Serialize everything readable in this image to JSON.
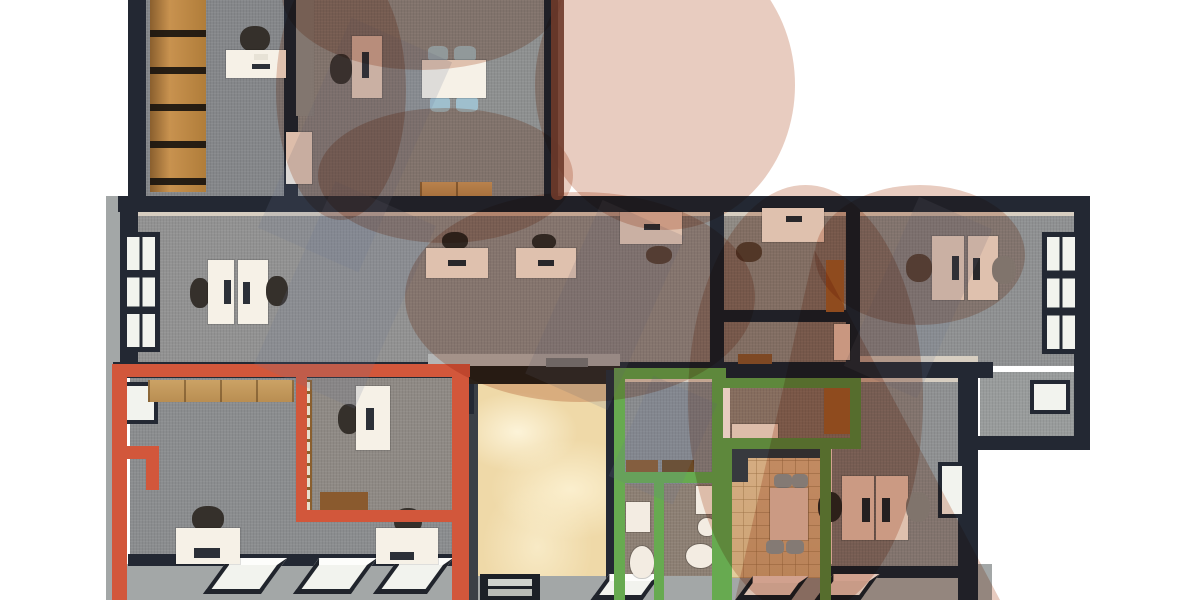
{
  "scene": {
    "kind": "3d-office-floor-plan-render",
    "visible_text": [],
    "watermark": {
      "description": "large translucent swirl logo over plan",
      "color": "#c98669",
      "dark_edge_color": "#6e3a2a"
    },
    "highlight_outlines": {
      "red_zone_color": "#d2573b",
      "green_zone_color": "#67aa50"
    }
  },
  "colors": {
    "wall": "#232833",
    "wall_inner": "#d7cec1",
    "exterior": "#a3a7a7",
    "red_zone": "#d2573b",
    "green_zone": "#67aa50",
    "marble": "#efd9a8",
    "tile": "#ead8ad",
    "wood": "#c8924f",
    "wood_light": "#cba265",
    "door_wood": "#ad7434",
    "desk": "#f6f1e7",
    "chair_dark": "#35302b",
    "chair_blue": "#9fbfcd",
    "fixture": "#f3ece2",
    "mat": "#8a5a2e",
    "glass": "#f2f3ee",
    "slate": "#3c4752",
    "watermark_rgba": "rgba(201,134,105,0.42)",
    "watermark_dark": "#6e3a2a"
  },
  "rooms": [
    {
      "id": "office-top-left",
      "floor": "#85878a",
      "contents": {
        "bookshelves": 1,
        "desks": 1,
        "chairs": 1
      }
    },
    {
      "id": "meeting-office-top-middle",
      "floor": "#8e9090",
      "contents": {
        "desks": 1,
        "tables": 1,
        "blue_chairs": 4,
        "sideboards": 1,
        "doors": 1
      }
    },
    {
      "id": "open-office",
      "floor": "#929292",
      "contents": {
        "desks": 5,
        "chairs": 5,
        "windows": 1
      }
    },
    {
      "id": "office-a-center",
      "floor": "#8f8a84",
      "contents": {
        "desks": 1,
        "chairs": 1,
        "doors": 1
      }
    },
    {
      "id": "small-room-b",
      "floor": "#8f8a84",
      "contents": {
        "mats": 1,
        "doors": 1
      }
    },
    {
      "id": "office-c-right",
      "floor": "#8f9192",
      "contents": {
        "desks": 2,
        "chairs": 2,
        "windows": 1
      }
    },
    {
      "id": "right-annex",
      "floor": "#999c9c",
      "contents": {
        "windows": 1
      }
    },
    {
      "id": "red-zone-team-room",
      "floor": "#8b8d8f",
      "contents": {
        "cabinets": 1,
        "desks": 2,
        "chairs": 2,
        "laptops": 2,
        "skylights": 3,
        "windows": 1
      }
    },
    {
      "id": "red-zone-inner-office",
      "floor": "#8f8a85",
      "contents": {
        "glass_partitions": 1,
        "desks": 1,
        "chairs": 1,
        "mats": 1
      }
    },
    {
      "id": "entry-hall-marble",
      "floor": "#efd9a8",
      "contents": {
        "entry_doors": 1
      }
    },
    {
      "id": "green-zone-vestibule",
      "floor": "#898b8e",
      "contents": {
        "mats": 2
      }
    },
    {
      "id": "green-zone-wc-left",
      "floor": "#8d8074",
      "contents": {
        "sinks": 1,
        "toilets": 1
      }
    },
    {
      "id": "green-zone-wc-right",
      "floor": "#8d8074",
      "contents": {
        "sinks": 1,
        "toilets": 1,
        "panels": 1
      }
    },
    {
      "id": "green-zone-reception",
      "floor": "#93887d",
      "contents": {
        "wood_desks": 1,
        "side_desks": 1
      }
    },
    {
      "id": "green-zone-kitchen",
      "floor": "#ead8ad",
      "contents": {
        "counters": 2,
        "tables": 1,
        "blue_chairs": 4
      }
    },
    {
      "id": "office-bottom-right",
      "floor": "#8f9192",
      "contents": {
        "desks": 2,
        "chairs": 2,
        "windows": 2
      }
    }
  ]
}
